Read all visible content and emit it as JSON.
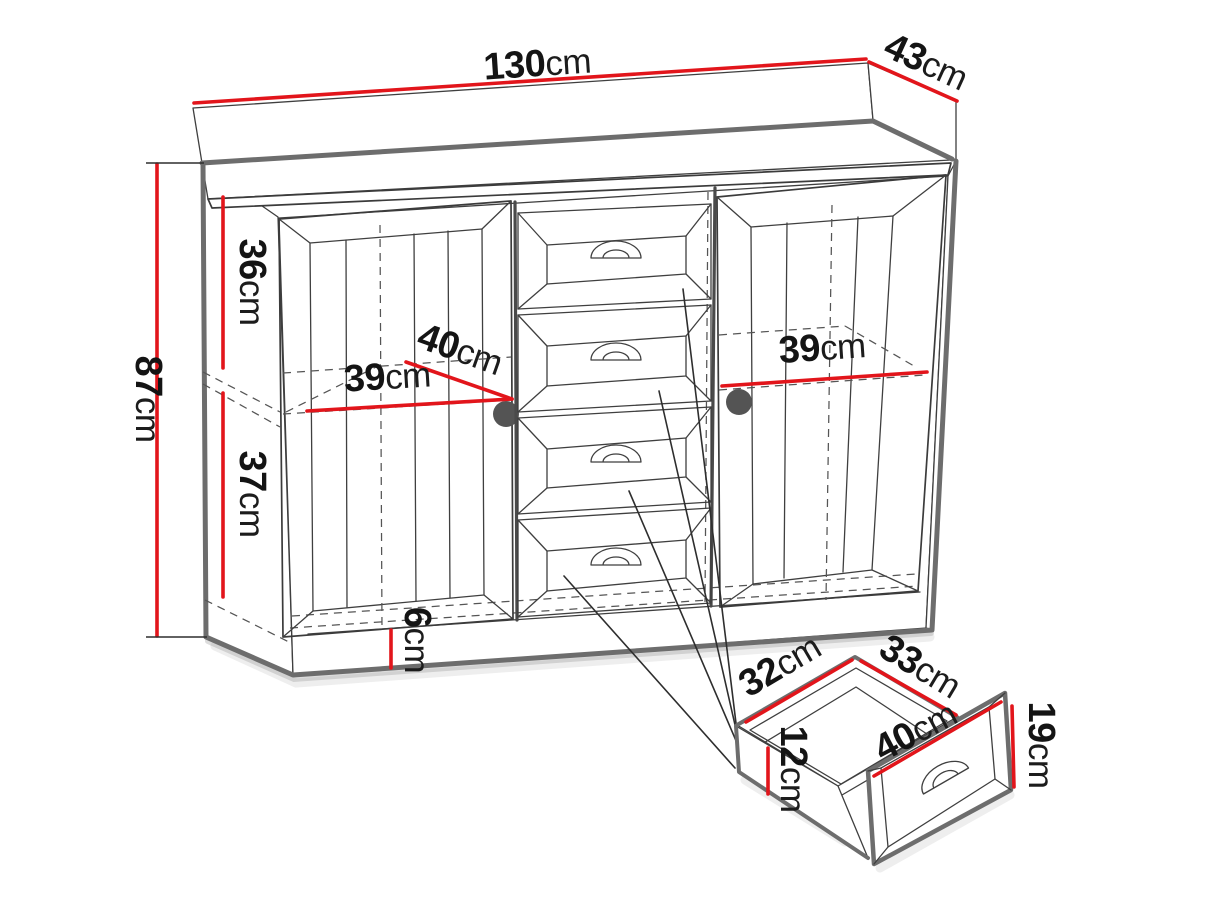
{
  "colors": {
    "background": "#ffffff",
    "dimension_red": "#e2151b",
    "outline_dark": "#3f3f3f",
    "edge_gray": "#6d6d6d",
    "knob_gray": "#545454",
    "text_black": "#141414"
  },
  "labels": {
    "cabinet_width": {
      "value": "130",
      "unit": "cm"
    },
    "cabinet_depth": {
      "value": "43",
      "unit": "cm"
    },
    "cabinet_height": {
      "value": "87",
      "unit": "cm"
    },
    "upper_compartment_height": {
      "value": "36",
      "unit": "cm"
    },
    "lower_compartment_height": {
      "value": "37",
      "unit": "cm"
    },
    "left_compartment_width": {
      "value": "39",
      "unit": "cm"
    },
    "compartment_depth": {
      "value": "40",
      "unit": "cm"
    },
    "right_compartment_width": {
      "value": "39",
      "unit": "cm"
    },
    "plinth_height": {
      "value": "6",
      "unit": "cm"
    },
    "drawer_inner_width": {
      "value": "32",
      "unit": "cm"
    },
    "drawer_inner_depth": {
      "value": "33",
      "unit": "cm"
    },
    "drawer_inner_height": {
      "value": "12",
      "unit": "cm"
    },
    "drawer_front_width": {
      "value": "40",
      "unit": "cm"
    },
    "drawer_front_height": {
      "value": "19",
      "unit": "cm"
    }
  }
}
